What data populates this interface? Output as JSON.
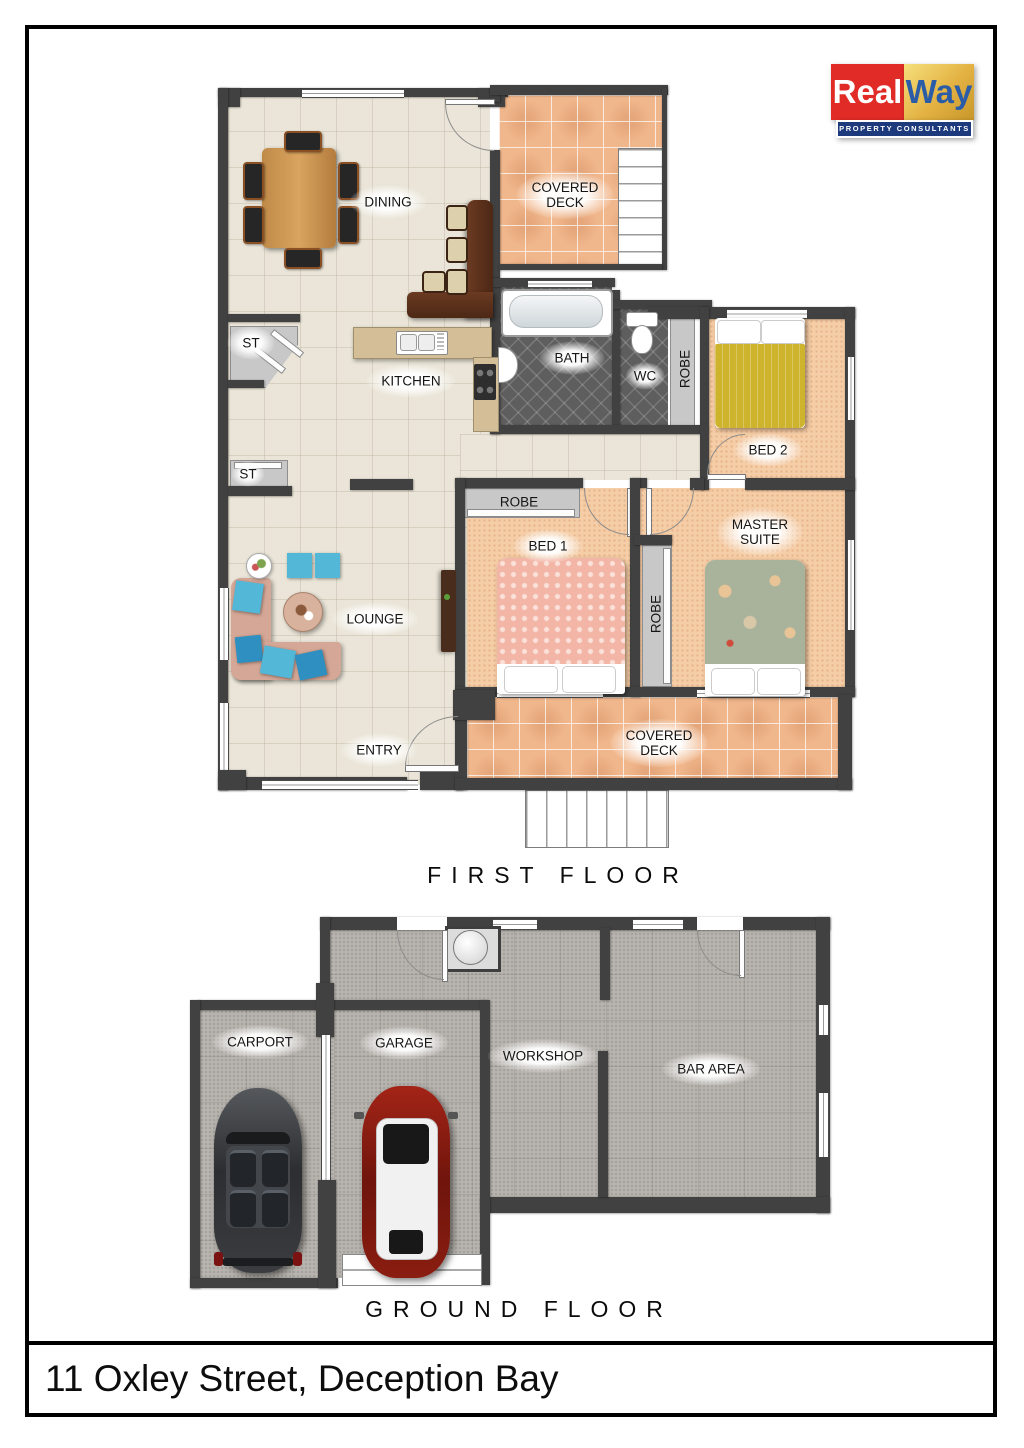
{
  "logo": {
    "brand_left": "Real",
    "brand_right": "Way",
    "tagline": "PROPERTY CONSULTANTS"
  },
  "address": "11 Oxley Street, Deception Bay",
  "floors": {
    "first": {
      "title": "FIRST FLOOR",
      "rooms": {
        "dining": "DINING",
        "deck_top_1": "COVERED",
        "deck_top_2": "DECK",
        "st_upper": "ST",
        "kitchen": "KITCHEN",
        "bath": "BATH",
        "wc": "WC",
        "robe_bed2": "ROBE",
        "bed2": "BED 2",
        "st_lower": "ST",
        "robe_bed1": "ROBE",
        "bed1": "BED 1",
        "master_1": "MASTER",
        "master_2": "SUITE",
        "robe_master": "ROBE",
        "lounge": "LOUNGE",
        "entry": "ENTRY",
        "deck_bottom_1": "COVERED",
        "deck_bottom_2": "DECK"
      }
    },
    "ground": {
      "title": "GROUND FLOOR",
      "rooms": {
        "carport": "CARPORT",
        "garage": "GARAGE",
        "workshop": "WORKSHOP",
        "bar": "BAR AREA"
      }
    }
  },
  "colors": {
    "wall": "#414141",
    "cream": "#eae5d8",
    "deck": "#f1b78c",
    "carpet": "#f5cda6",
    "bath": "#5e5e5e",
    "robe": "#c8c8c8",
    "conc": "#b7b3ae",
    "sofa": "#d5a796",
    "aqua": "#53b7d8",
    "logo-red": "#e02b26",
    "logo-gold": "#e3b243",
    "logo-navy": "#1d3a7d",
    "way-blue": "#2a5ca8"
  }
}
